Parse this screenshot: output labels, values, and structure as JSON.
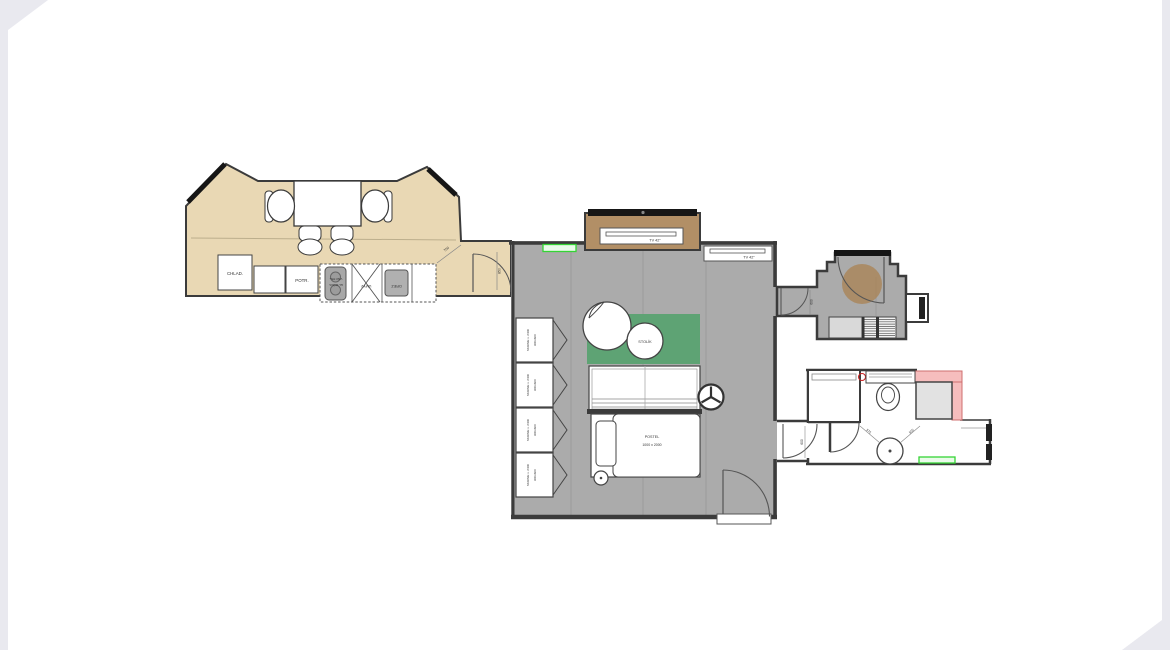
{
  "palette": {
    "page_edge": "#e9e9ef",
    "kitchen_fill": "#e9d8b4",
    "room_gray": "#ababab",
    "wall_dark": "#3b3b3b",
    "alcove_brown": "#b28f66",
    "entry_rug_brown": "#aa8458",
    "rug_green": "#5ea374",
    "highlight_green": "#35d435",
    "shower_pink": "#f6bdbd",
    "shower_gray": "#e2e2e2",
    "appliance_gray": "#a8a8a8"
  },
  "kitchen": {
    "fridge": "CHLAD.",
    "pantry": "POTR.",
    "cooktop_line1": "VAR.TB+",
    "cooktop_line2": "EL.RÚRA",
    "washbasin": "UMYV.",
    "sink": "DREZ"
  },
  "living": {
    "tv_main": "TV 42\"",
    "tv_side": "TV 42\"",
    "side_table": "STOLÍK",
    "bed_line1": "POSTEL",
    "bed_line2": "1000 x 2000",
    "wardrobes": [
      {
        "line1": "SKRINE v. 2400",
        "line2": "900x600"
      },
      {
        "line1": "SKRINE v. 2400",
        "line2": "900x600"
      },
      {
        "line1": "SKRINE v. 2400",
        "line2": "900x600"
      },
      {
        "line1": "SKRINE v. 2400",
        "line2": "900x600"
      }
    ]
  },
  "dimensions": {
    "kitchen_diag": "750",
    "kitchen_door": "850",
    "entry_door": "600",
    "bath_door": "600",
    "washer_left": "575",
    "washer_right": "555"
  }
}
